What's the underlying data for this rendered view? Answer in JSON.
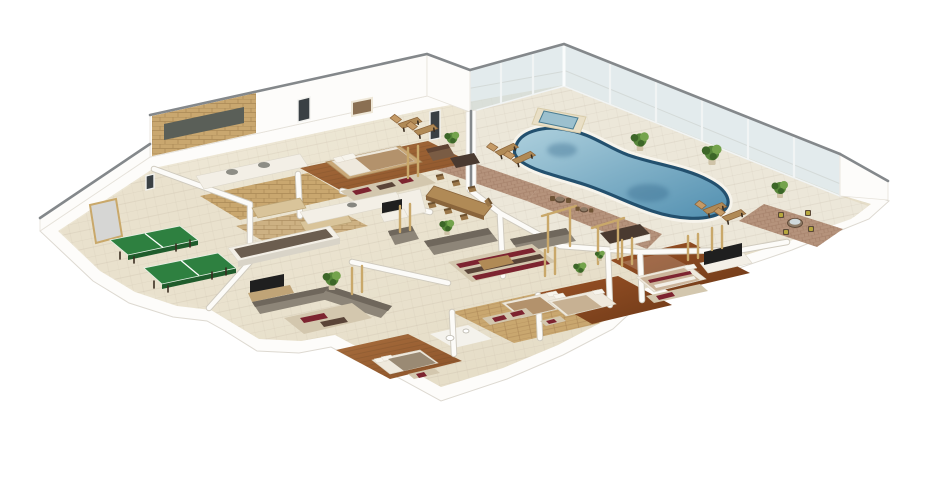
{
  "scene": {
    "type": "3d-isometric-floor-plan",
    "background": "transparent-on-white",
    "rooms": [
      "games room",
      "bathroom",
      "walk-in closet",
      "master bedroom",
      "kitchen",
      "dining area",
      "living room",
      "family room",
      "bedroom",
      "bedroom",
      "bedroom",
      "indoor pool terrace",
      "corner patio"
    ],
    "features": {
      "swimming_pool": 1,
      "hot_tub": 1,
      "table_tennis_tables": 2,
      "beds": 5,
      "sofas": 4,
      "sun_loungers": 6,
      "patio_dining_sets": 3,
      "potted_plants": 8,
      "tv_screens": 3,
      "glass_wall_runs": 2
    }
  },
  "colors": {
    "page_bg": "#ffffff",
    "wall_white": "#fdfcfa",
    "wall_edge": "#ddd9d1",
    "wall_cap": "#84888b",
    "deck": "#ece7d9",
    "glass": "#ccdade",
    "glass_frame": "#f1f4f4",
    "pool_rim": "#23506e",
    "water_light": "#aed0dd",
    "water_deep": "#518fb0",
    "water_shadow": "#2f6286",
    "tub_body": "#e9dfc6",
    "tub_water": "#9cc0ce",
    "brick": "#b5937c",
    "stone": "#c9a76f",
    "mirror": "#5a5f58",
    "wood": "#b08a56",
    "wood_dark": "#8a653c",
    "tt_green": "#2e8040",
    "tt_leg": "#3a2d20",
    "sofa": "#8d8578",
    "sofa_dark": "#6f675c",
    "rug": "#d3c7ae",
    "rug_red": "#7d2430",
    "rug_brown": "#5a4438",
    "bed_white": "#efe9dd",
    "bed_tan": "#b3926c",
    "plant": "#57873a",
    "plant_light": "#74a34c",
    "plant_dark": "#3c6628",
    "tv": "#1f1f1f",
    "counter_dark": "#4a3a30",
    "cream": "#f3efe6",
    "door_gray": "#d6d6d4",
    "frame_tan": "#c9a86a"
  }
}
